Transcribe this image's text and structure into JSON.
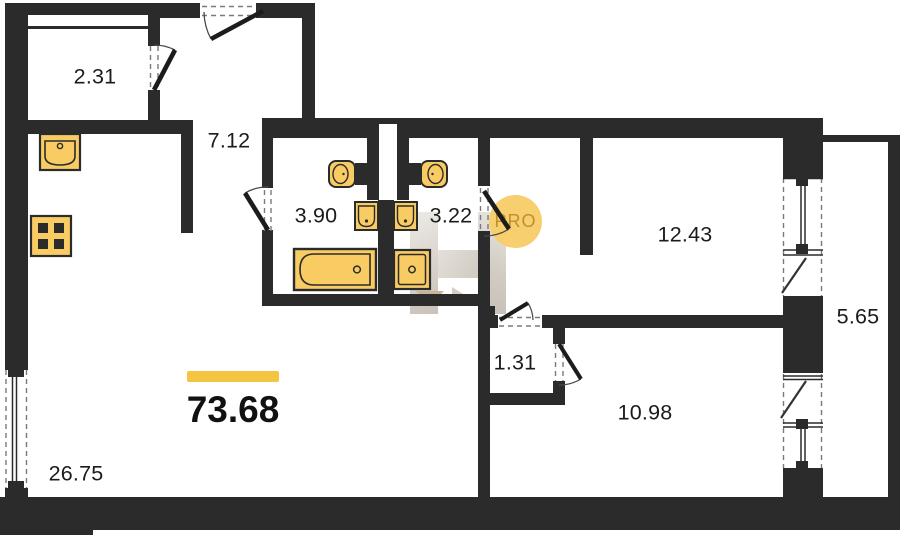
{
  "plan": {
    "badge": {
      "text": "PRO"
    },
    "total": {
      "value": "73.68"
    },
    "rooms": [
      {
        "name": "storage-room",
        "area": "2.31"
      },
      {
        "name": "hallway",
        "area": "7.12"
      },
      {
        "name": "bathroom",
        "area": "3.90"
      },
      {
        "name": "toilet-room",
        "area": "3.22"
      },
      {
        "name": "bedroom-1",
        "area": "12.43"
      },
      {
        "name": "balcony",
        "area": "5.65"
      },
      {
        "name": "vestibule",
        "area": "1.31"
      },
      {
        "name": "bedroom-2",
        "area": "10.98"
      },
      {
        "name": "living-kitchen",
        "area": "26.75"
      }
    ],
    "fixtures": [
      "kitchen-sink",
      "stove-4-burner",
      "toilet",
      "toilet",
      "wash-basin",
      "wash-basin",
      "bathtub",
      "shower-tray"
    ],
    "colors": {
      "wall": "#2b2b2b",
      "fixture_fill": "#f8cc63",
      "accent_bar": "#f5c541",
      "badge_bg": "#f7cf6e",
      "badge_text": "#c08f2f",
      "watermark": "#d6d0c8"
    }
  }
}
